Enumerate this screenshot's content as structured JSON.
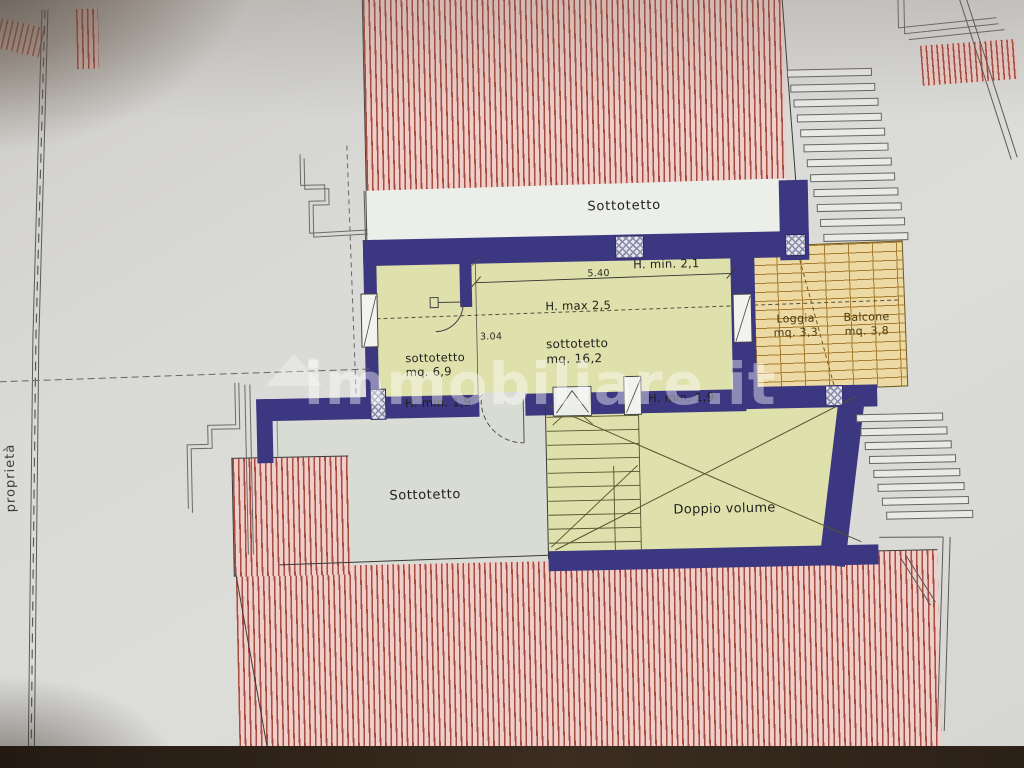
{
  "photo": {
    "watermark": "immobiliare.it"
  },
  "plan": {
    "upper": {
      "attic_band_label": "Sottotetto",
      "h_min_21": "H. min. 2,1",
      "dim_540": "5.40",
      "h_max_25": "H. max 2,5",
      "room_small": {
        "line1": "sottotetto",
        "line2": "mq. 6,9"
      },
      "room_main": {
        "line1": "sottotetto",
        "line2": "mq. 16,2"
      },
      "dim_304": "3.04",
      "h_min_19_left": "H. min. 1,9",
      "h_min_19_right": "H. min. 1,9"
    },
    "terrace": {
      "loggia": {
        "line1": "Loggia",
        "line2": "mq. 3,3"
      },
      "balcone": {
        "line1": "Balcone",
        "line2": "mq. 3,8"
      }
    },
    "lower": {
      "attic_label": "Sottotetto",
      "double_volume_label": "Doppio volume"
    },
    "boundary": {
      "property_label": "proprietà"
    },
    "colors": {
      "wall": "#3c3781",
      "room_green": "#dfe1ac",
      "roof_bg": "#eecfc9",
      "roof_line": "#a84c42",
      "loggia_bg": "#ecd9a4",
      "loggia_line": "#a87c2e"
    }
  }
}
